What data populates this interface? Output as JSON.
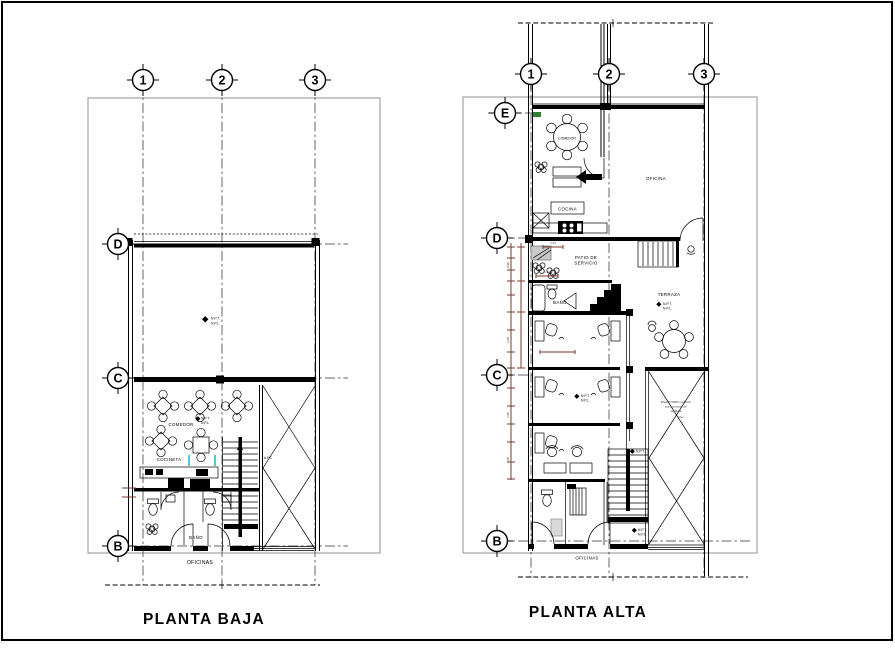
{
  "drawing": {
    "left_title": "PLANTA BAJA",
    "right_title": "PLANTA ALTA"
  },
  "grid": {
    "cols": [
      "1",
      "2",
      "3"
    ],
    "left_rows": [
      "D",
      "C",
      "B"
    ],
    "right_rows": [
      "E",
      "D",
      "C",
      "B"
    ]
  },
  "planta_baja": {
    "comedor": "COMEDOR",
    "cocineta": "COCINETA",
    "bano": "BAÑO",
    "oficinas": "OFICINAS",
    "npt": "N.P.T.",
    "npl": "N.P.L.",
    "ap": "A.P.1"
  },
  "planta_alta": {
    "comedor": "COMEDOR",
    "cocina": "COCINA",
    "oficina": "OFICINA",
    "patio_line1": "PATIO DE",
    "patio_line2": "SERVICIO",
    "bano": "BAÑO",
    "terraza": "TERRAZA",
    "oficinas": "OFICINAS",
    "npt": "N.P.T.",
    "npl": "N.P.L.",
    "note_line1": "ESCRITORIO LARGO",
    "note_line2": "por acomodo de",
    "note_line3": "periferia",
    "note_line4": "piso"
  },
  "dims": {
    "d1": "1.27",
    "d2": "1.10",
    "d3": "0.90",
    "d4": "2.05",
    "d5": "1.05",
    "d6": "1.00"
  },
  "colors": {
    "line": "#000000",
    "plan_box": "#9a9a9a",
    "dimension": "#7b3a30",
    "accent_cyan": "#17b8cc",
    "accent_green": "#2e7d32",
    "paper": "#ffffff"
  }
}
